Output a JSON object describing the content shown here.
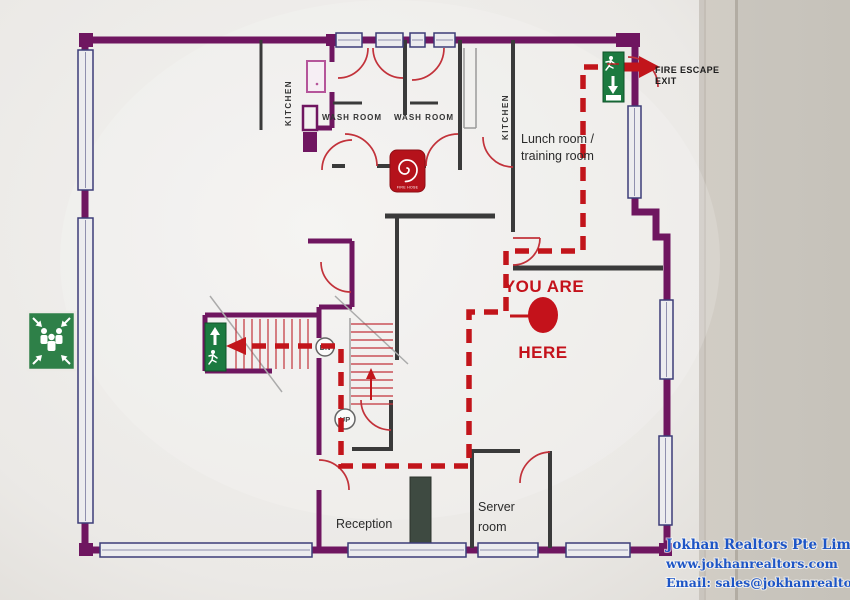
{
  "plan": {
    "rooms": {
      "kitchen_left": "KITCHEN",
      "washroom_1": "WASH ROOM",
      "washroom_2": "WASH ROOM",
      "kitchen_right": "KITCHEN",
      "lunch_line1": "Lunch room /",
      "lunch_line2": "training room",
      "reception": "Reception",
      "server_line1": "Server",
      "server_line2": "room"
    },
    "marker": {
      "line1": "YOU ARE",
      "line2": "HERE"
    },
    "fire_escape": {
      "line1": "FIRE ESCAPE",
      "line2": "EXIT"
    },
    "stairs": {
      "down": "DN",
      "up": "UP"
    },
    "fire_hose_label": "FIRE HOSE",
    "colors": {
      "outer_wall": "#6f1660",
      "interior_wall": "#3a3a3a",
      "escape_route_red": "#c2151b",
      "marker_red": "#c4121b",
      "exit_sign_green": "#1c7a40",
      "fire_hose_red": "#b5121b",
      "window_frame_blue": "#3d3d78"
    },
    "icons": {
      "assembly_point": "assembly-point",
      "exit_top": "running-man-exit-down",
      "exit_stairs": "running-man-exit-up",
      "fire_hose": "fire-hose-reel-spiral",
      "fire_escape_arrow": "right-arrow",
      "route_arrow": "left-arrow"
    }
  },
  "watermark": {
    "company": "Jokhan Realtors Pte Limited",
    "website": "www.jokhanrealtors.com",
    "email": "Email: sales@jokhanrealtors.com",
    "color": "#1d55c6"
  }
}
